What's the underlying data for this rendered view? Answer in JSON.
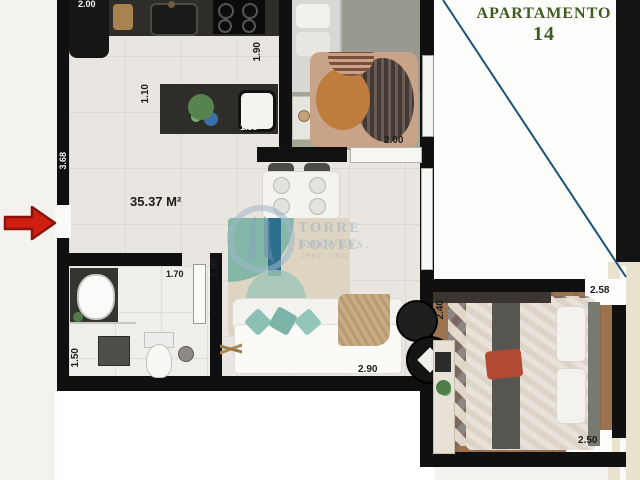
{
  "header": {
    "title": "APARTAMENTO",
    "unit_number": "14"
  },
  "plan": {
    "area_label": "35.37 M²"
  },
  "watermark": {
    "brand": "TORRE FORTE",
    "brand_line2": "IMÓVEIS.",
    "creci": "CRECI 27911"
  },
  "dimensions": {
    "fridge_wall": "2.00",
    "island_width": "1.10",
    "island_length": "1.35",
    "kitchen_depth": "1.90",
    "bedroom1_width": "2.00",
    "entry_wall_height": "3.68",
    "hallway": "1.65",
    "bathroom_width": "1.70",
    "bathroom_depth": "1.50",
    "living_width": "2.90",
    "bedroom2_left": "2.40",
    "bedroom2_right": "2.58",
    "bedroom2_bottom": "2.50"
  },
  "colors": {
    "title_green": "#3e5c21",
    "arrow_red": "#d01f10",
    "marker_blue": "#1d5276",
    "wall_black": "#101010",
    "watermark_blue": "#9ab0c4"
  }
}
